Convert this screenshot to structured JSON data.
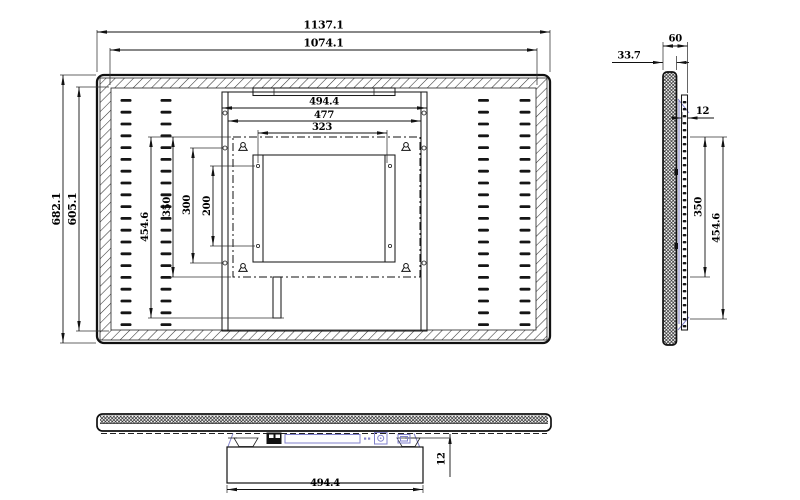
{
  "colors": {
    "background": "#ffffff",
    "line": "#1a1a1a",
    "accent": "#8282cc",
    "text": "#000000"
  },
  "front_view": {
    "dims": {
      "overall_width": "1137.1",
      "visible_width": "1074.1",
      "plate_width": "494.4",
      "rail_width": "477",
      "hole_span_width": "323",
      "overall_height": "682.1",
      "visible_height": "605.1",
      "bracket_height": "454.6",
      "plate_height": "350",
      "rail_height": "300",
      "hole_span_height": "200"
    }
  },
  "side_view": {
    "dims": {
      "total_depth": "60",
      "panel_depth": "33.7",
      "plate_thickness": "12",
      "plate_height": "350",
      "bracket_height": "454.6"
    }
  },
  "bottom_view": {
    "dims": {
      "bracket_width": "494.4",
      "bracket_offset": "12"
    }
  }
}
